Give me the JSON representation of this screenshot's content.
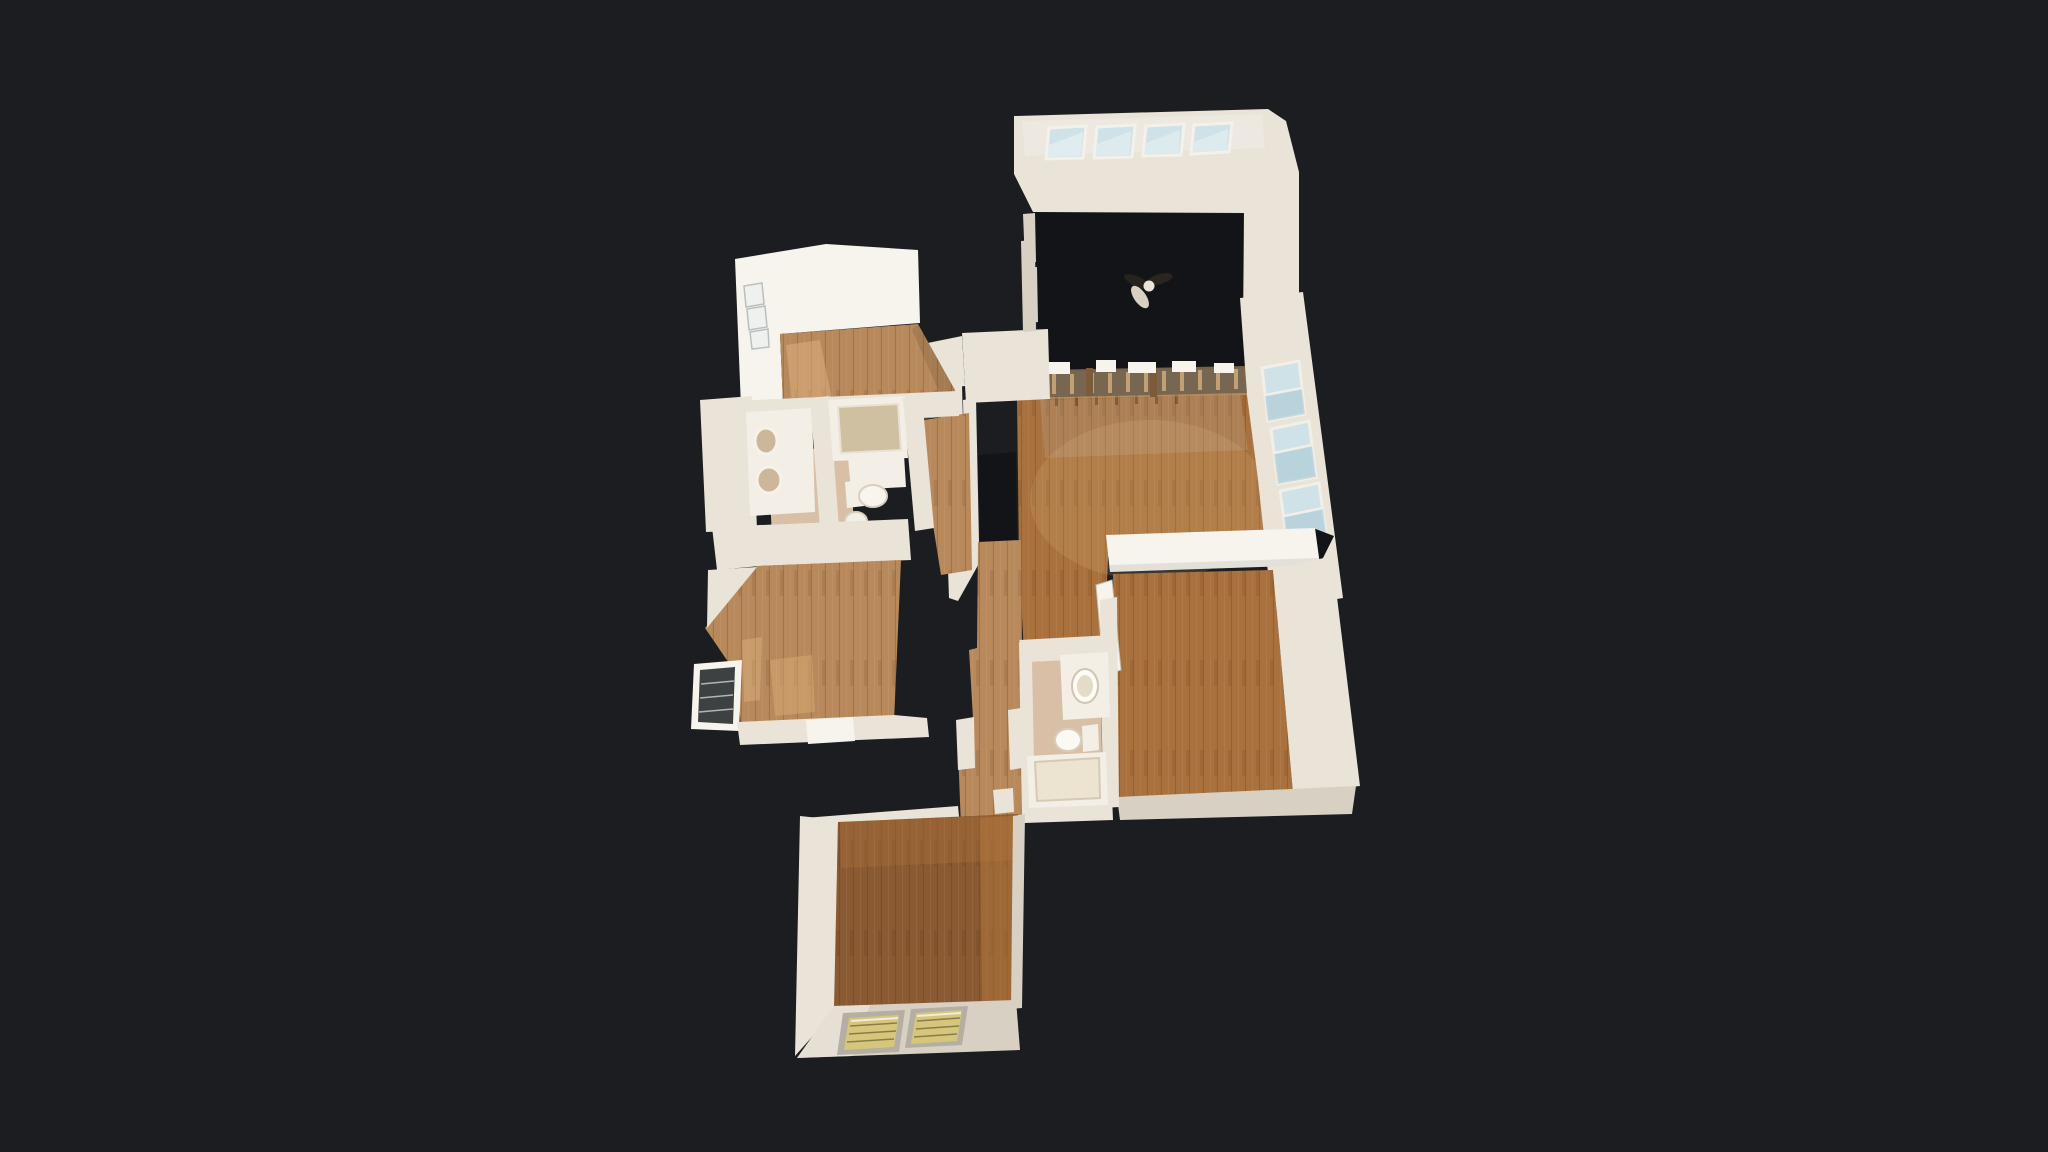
{
  "viewer": {
    "mode": "dollhouse-top-down-3d-scan",
    "background": "#1b1d20"
  },
  "colors": {
    "bg": "#1b1d20",
    "void": "#121417",
    "wall": "#e9e3d8",
    "wall_bright": "#f7f4ed",
    "wall_dim": "#d8d1c3",
    "wood": "#a9713d",
    "wood_pale": "#b8895b",
    "wood_dark": "#8a5a32",
    "tile": "#d8bfa6",
    "fixture": "#f3efe6",
    "glass_cool": "#cfe2e8",
    "glass_warm": "#d6c67c",
    "glass_bright": "#eff1ee",
    "blind_dark": "#3e4142",
    "railing": "#c2a379"
  },
  "scene": {
    "rooms": [
      {
        "id": "bonus-room",
        "features": [
          "clerestory-windows-x4",
          "ceiling-fan",
          "unscanned-dark-floor"
        ]
      },
      {
        "id": "living-room",
        "features": [
          "stair-railing",
          "window-wall-x3",
          "wood-floor"
        ]
      },
      {
        "id": "bedroom-upper-left",
        "features": [
          "left-window-column",
          "wood-floor",
          "sunlight-patch"
        ]
      },
      {
        "id": "bathroom-upper",
        "features": [
          "double-sink-vanity",
          "bathtub",
          "toilet",
          "pedestal-sink",
          "tile-floor"
        ]
      },
      {
        "id": "bedroom-middle-left",
        "features": [
          "blinds-window",
          "wood-floor",
          "sunlight-patch"
        ]
      },
      {
        "id": "hallway",
        "features": [
          "wood-floor",
          "closet-nook"
        ]
      },
      {
        "id": "bathroom-lower",
        "features": [
          "vanity-sink",
          "toilet",
          "bathtub",
          "tile-floor"
        ]
      },
      {
        "id": "master-bedroom",
        "features": [
          "counter-half-wall",
          "door-leaf",
          "wood-floor"
        ]
      },
      {
        "id": "lower-room",
        "features": [
          "warm-blind-windows-x2",
          "dark-wood-floor"
        ]
      }
    ]
  }
}
